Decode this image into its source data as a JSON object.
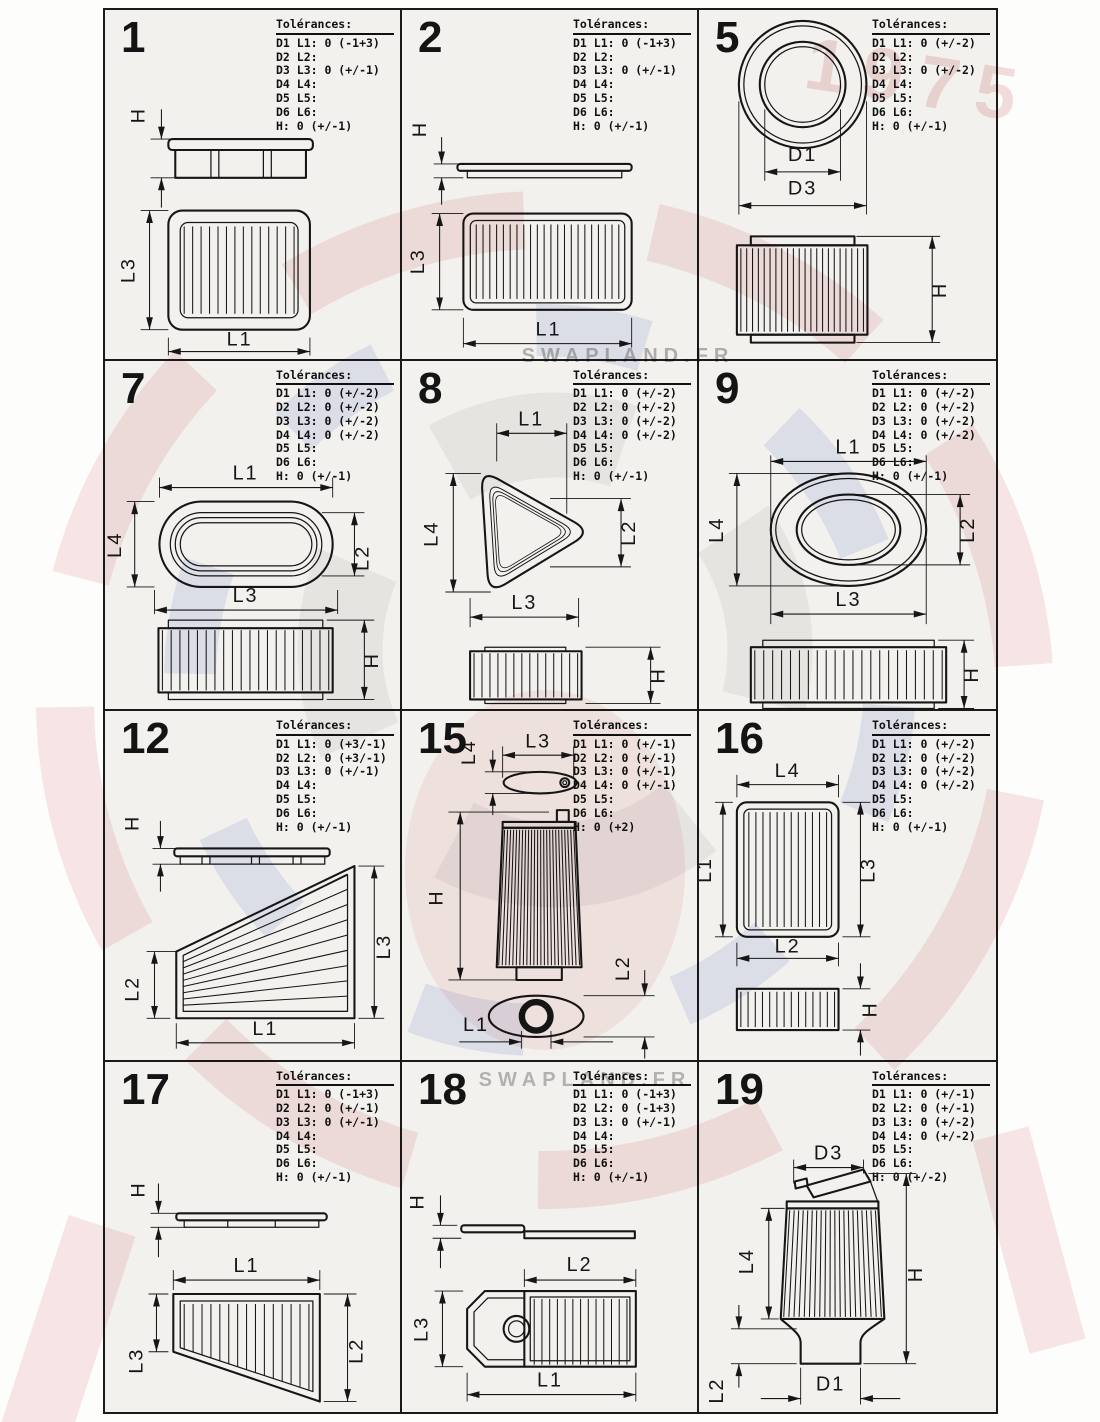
{
  "page": {
    "watermark": {
      "text1": "SWAPLAND.FR",
      "text2": "SWAPLAND.FR",
      "badge": "1975"
    },
    "colors": {
      "line": "#161616",
      "paper": "#f2f1ee",
      "wm_red": "#c8373a",
      "wm_blue": "#3c55c8",
      "wm_gray": "#9a9a9a"
    }
  },
  "panels": [
    {
      "number": "1",
      "tol_title": "Tolérances:",
      "tol_lines": [
        "D1 L1: 0 (-1+3)",
        "D2 L2:",
        "D3 L3: 0 (+/-1)",
        "D4 L4:",
        "D5 L5:",
        "D6 L6:",
        "H: 0 (+/-1)"
      ],
      "dims": {
        "h": "H",
        "l3": "L3",
        "l1": "L1"
      }
    },
    {
      "number": "2",
      "tol_title": "Tolérances:",
      "tol_lines": [
        "D1 L1: 0 (-1+3)",
        "D2 L2:",
        "D3 L3: 0 (+/-1)",
        "D4 L4:",
        "D5 L5:",
        "D6 L6:",
        "H: 0 (+/-1)"
      ],
      "dims": {
        "h": "H",
        "l3": "L3",
        "l1": "L1"
      }
    },
    {
      "number": "5",
      "tol_title": "Tolérances:",
      "tol_lines": [
        "D1 L1: 0 (+/-2)",
        "D2 L2:",
        "D3 L3: 0 (+/-2)",
        "D4 L4:",
        "D5 L5:",
        "D6 L6:",
        "H: 0 (+/-1)"
      ],
      "dims": {
        "d1": "D1",
        "d3": "D3",
        "h": "H"
      }
    },
    {
      "number": "7",
      "tol_title": "Tolérances:",
      "tol_lines": [
        "D1 L1: 0 (+/-2)",
        "D2 L2: 0 (+/-2)",
        "D3 L3: 0 (+/-2)",
        "D4 L4: 0 (+/-2)",
        "D5 L5:",
        "D6 L6:",
        "H: 0 (+/-1)"
      ],
      "dims": {
        "l1": "L1",
        "l4": "L4",
        "l2": "L2",
        "l3": "L3",
        "h": "H"
      }
    },
    {
      "number": "8",
      "tol_title": "Tolérances:",
      "tol_lines": [
        "D1 L1: 0 (+/-2)",
        "D2 L2: 0 (+/-2)",
        "D3 L3: 0 (+/-2)",
        "D4 L4: 0 (+/-2)",
        "D5 L5:",
        "D6 L6:",
        "H: 0 (+/-1)"
      ],
      "dims": {
        "l1": "L1",
        "l4": "L4",
        "l2": "L2",
        "l3": "L3",
        "h": "H"
      }
    },
    {
      "number": "9",
      "tol_title": "Tolérances:",
      "tol_lines": [
        "D1 L1: 0 (+/-2)",
        "D2 L2: 0 (+/-2)",
        "D3 L3: 0 (+/-2)",
        "D4 L4: 0 (+/-2)",
        "D5 L5:",
        "D6 L6:",
        "H: 0 (+/-1)"
      ],
      "dims": {
        "l1": "L1",
        "l4": "L4",
        "l2": "L2",
        "l3": "L3",
        "h": "H"
      }
    },
    {
      "number": "12",
      "tol_title": "Tolérances:",
      "tol_lines": [
        "D1 L1: 0 (+3/-1)",
        "D2 L2: 0 (+3/-1)",
        "D3 L3: 0 (+/-1)",
        "D4 L4:",
        "D5 L5:",
        "D6 L6:",
        "H: 0 (+/-1)"
      ],
      "dims": {
        "h": "H",
        "l2": "L2",
        "l3": "L3",
        "l1": "L1"
      }
    },
    {
      "number": "15",
      "tol_title": "Tolérances:",
      "tol_lines": [
        "D1 L1: 0 (+/-1)",
        "D2 L2: 0 (+/-1)",
        "D3 L3: 0 (+/-1)",
        "D4 L4: 0 (+/-1)",
        "D5 L5:",
        "D6 L6:",
        "H: 0 (+2)"
      ],
      "dims": {
        "l4": "L4",
        "l3": "L3",
        "h": "H",
        "l2": "L2",
        "l1": "L1"
      }
    },
    {
      "number": "16",
      "tol_title": "Tolérances:",
      "tol_lines": [
        "D1 L1: 0 (+/-2)",
        "D2 L2: 0 (+/-2)",
        "D3 L3: 0 (+/-2)",
        "D4 L4: 0 (+/-2)",
        "D5 L5:",
        "D6 L6:",
        "H: 0 (+/-1)"
      ],
      "dims": {
        "l4": "L4",
        "l1": "L1",
        "l3": "L3",
        "l2": "L2",
        "h": "H"
      }
    },
    {
      "number": "17",
      "tol_title": "Tolérances:",
      "tol_lines": [
        "D1 L1: 0 (-1+3)",
        "D2 L2: 0 (+/-1)",
        "D3 L3: 0 (+/-1)",
        "D4 L4:",
        "D5 L5:",
        "D6 L6:",
        "H: 0 (+/-1)"
      ],
      "dims": {
        "h": "H",
        "l1": "L1",
        "l3": "L3",
        "l2": "L2"
      }
    },
    {
      "number": "18",
      "tol_title": "Tolérances:",
      "tol_lines": [
        "D1 L1: 0 (-1+3)",
        "D2 L2: 0 (-1+3)",
        "D3 L3: 0 (+/-1)",
        "D4 L4:",
        "D5 L5:",
        "D6 L6:",
        "H: 0 (+/-1)"
      ],
      "dims": {
        "h": "H",
        "l2": "L2",
        "l3": "L3",
        "l1": "L1"
      }
    },
    {
      "number": "19",
      "tol_title": "Tolérances:",
      "tol_lines": [
        "D1 L1: 0 (+/-1)",
        "D2 L2: 0 (+/-1)",
        "D3 L3: 0 (+/-2)",
        "D4 L4: 0 (+/-2)",
        "D5 L5:",
        "D6 L6:",
        "H: 0 (+/-2)"
      ],
      "dims": {
        "d3": "D3",
        "l4": "L4",
        "h": "H",
        "l2": "L2",
        "d1": "D1"
      }
    }
  ]
}
